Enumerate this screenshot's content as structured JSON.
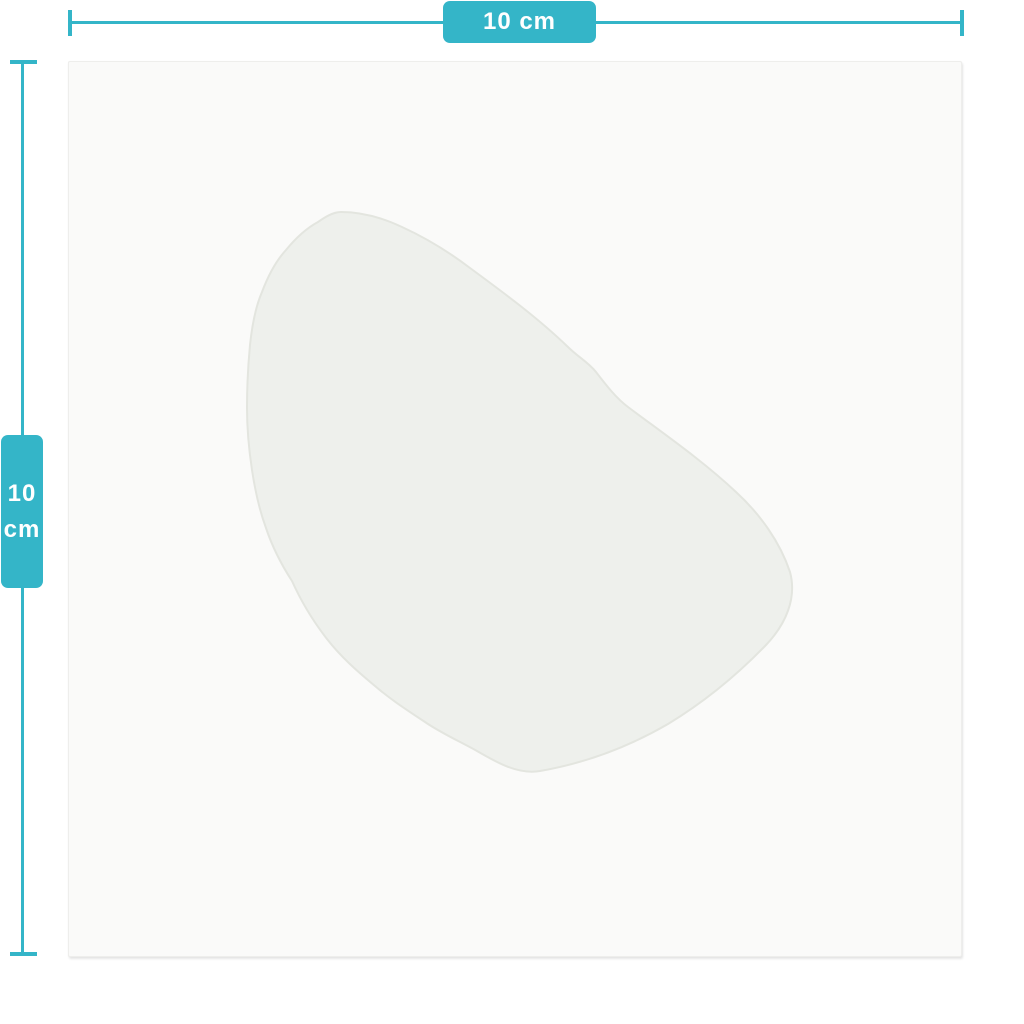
{
  "diagram": {
    "width_dimension": {
      "label": "10 cm"
    },
    "height_dimension": {
      "value": "10",
      "unit": "cm"
    }
  },
  "colors": {
    "accent": "#34b5c8",
    "background": "#ffffff",
    "sheet": "#fafaf9",
    "sheet_border": "#eeeeec",
    "patch_fill": "#eef0ec",
    "patch_edge": "#e3e5df",
    "badge_text": "#ffffff"
  }
}
